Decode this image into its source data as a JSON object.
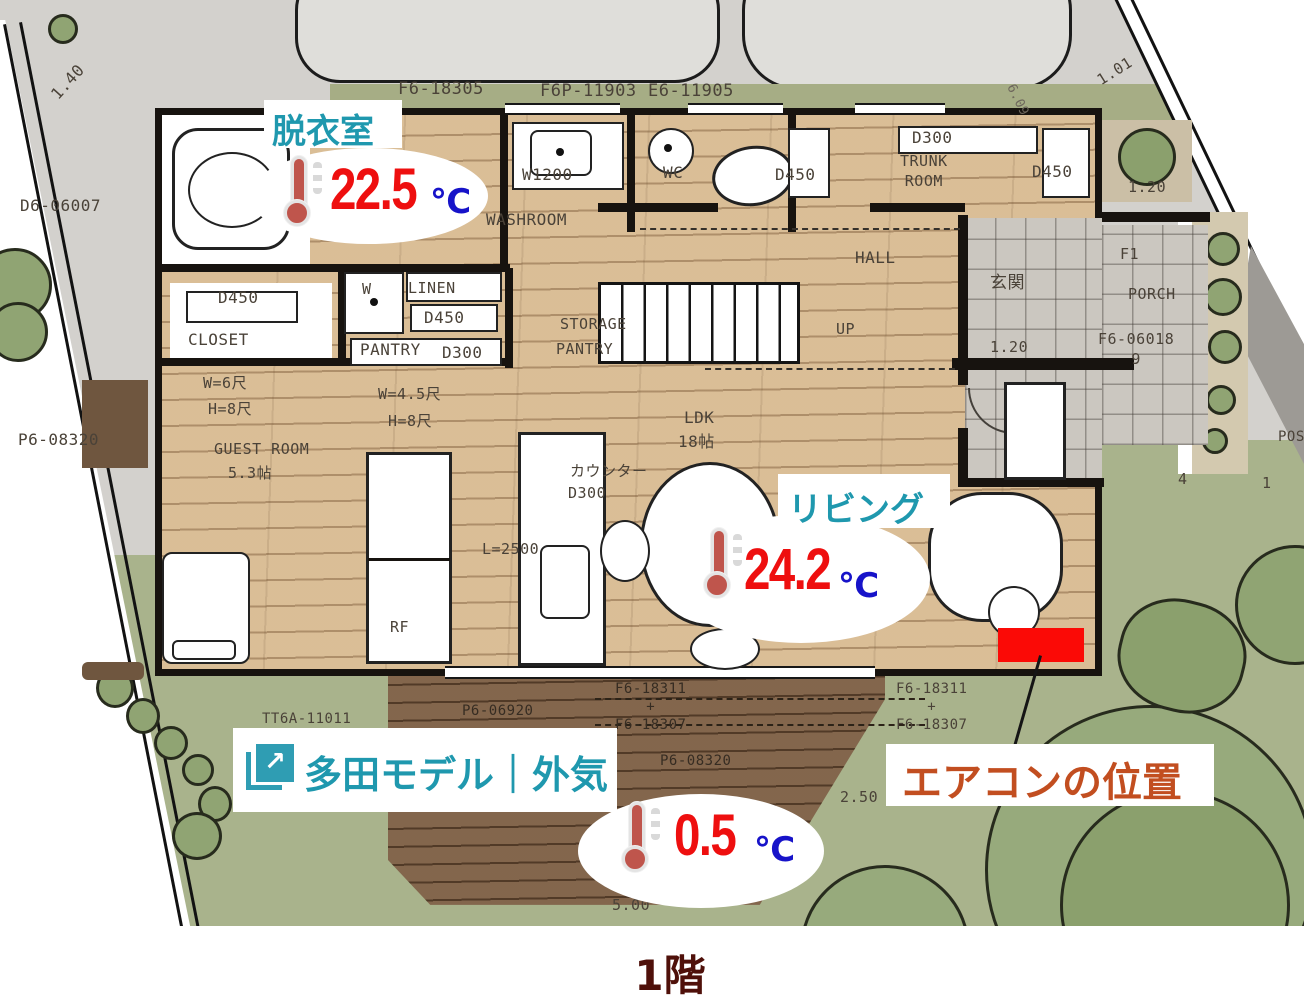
{
  "title": "1階",
  "colors": {
    "accent_teal": "#1f98ae",
    "temp_red": "#ee0f0f",
    "unit_blue": "#1713c9",
    "ac_label_text": "#c24e20",
    "ac_marker_red": "#fb0a06",
    "floor_title": "#4f100a",
    "wood_floor": "#e2c7a0",
    "garden_green": "#a9b38c",
    "deck_brown": "#7b5d43"
  },
  "icons": {
    "external_link": "↗",
    "thermometer": "thermometer-icon"
  },
  "sensors": {
    "dressing": {
      "room": "脱衣室",
      "value": "22.5",
      "unit": "℃"
    },
    "living": {
      "room": "リビング",
      "value": "24.2",
      "unit": "℃"
    },
    "outdoor": {
      "room": "多田モデル｜外気",
      "value": "0.5",
      "unit": "℃"
    }
  },
  "ac_note": {
    "label": "エアコンの位置"
  },
  "plan": {
    "labels": [
      "F6-18305",
      "F6P-11903",
      "E6-11905",
      "1.40",
      "D6-06007",
      "1.01",
      "6.09",
      "D450",
      "CLOSET",
      "W",
      "LINEN",
      "D450",
      "PANTRY",
      "D300",
      "W1200",
      "WASHROOM",
      "WC",
      "D450",
      "D300",
      "TRUNK\nROOM",
      "D450",
      "HALL",
      "玄関",
      "F1",
      "PORCH",
      "1.20",
      "1.20",
      "F6-06018\n9",
      "STORAGE",
      "PANTRY",
      "UP",
      "W=6尺",
      "H=8尺",
      "W=4.5尺",
      "H=8尺",
      "GUEST ROOM",
      "5.3帖",
      "LDK",
      "18帖",
      "カウンター",
      "D300",
      "L=2500",
      "RF",
      "P6-08320",
      "F6-18311\n+\nF6-18307",
      "P6-06920",
      "TT6A-11011",
      "P6-08320",
      "F6-18311\n+\nF6-18307",
      "2.50",
      "5.00",
      "4",
      "1",
      "POST"
    ]
  }
}
